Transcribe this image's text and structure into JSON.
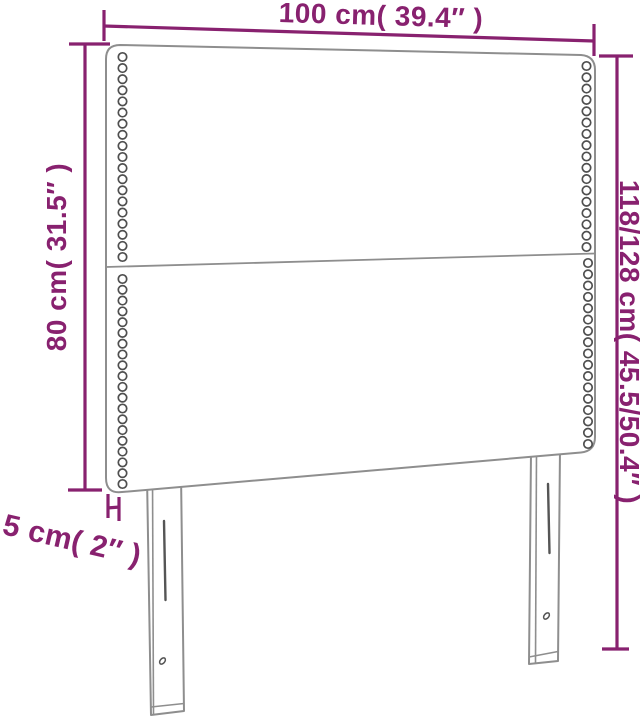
{
  "diagram_title": "headboard-dimension-diagram",
  "labels": {
    "width": "100 cm( 39.4″ )",
    "height_left": "80 cm( 31.5″ )",
    "height_right": "118/128 cm( 45.5/50.4″ )",
    "thickness": "5 cm( 2″ )"
  },
  "colors": {
    "dimension": "#88216F",
    "outline": "#8E8E8E",
    "stud": "#4F4F4F",
    "detail": "#555555",
    "background": "#FFFFFF"
  },
  "studs": {
    "radius": 4.2,
    "columns": [
      {
        "name": "upper-left",
        "x": 122.5,
        "y_start": 57,
        "y_end": 257,
        "count": 19
      },
      {
        "name": "upper-right",
        "x": 586.5,
        "y_start": 66,
        "y_end": 247,
        "count": 17
      },
      {
        "name": "lower-left",
        "x": 122.5,
        "y_start": 279,
        "y_end": 484,
        "count": 20
      },
      {
        "name": "lower-right",
        "x": 588,
        "y_start": 263,
        "y_end": 444,
        "count": 17
      }
    ]
  }
}
